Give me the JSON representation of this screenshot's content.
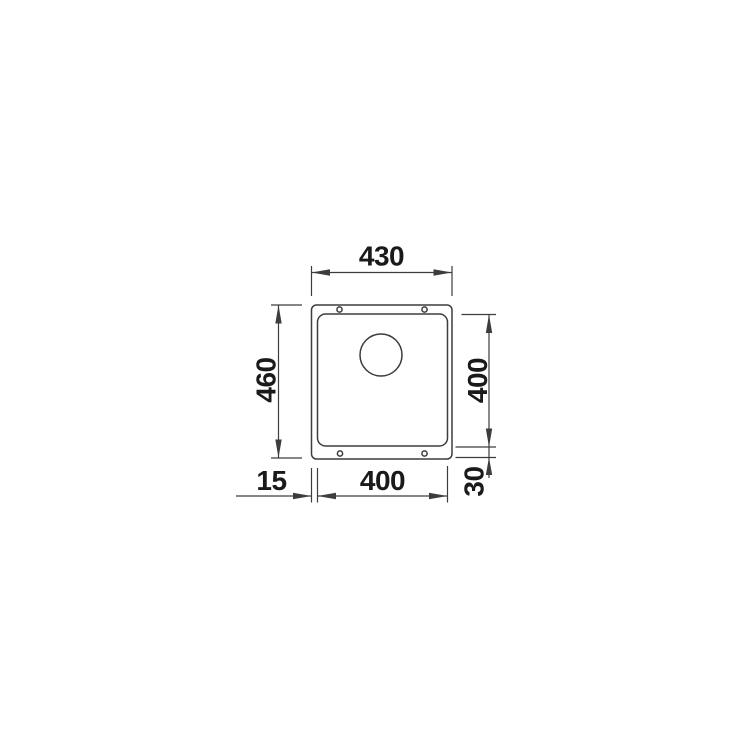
{
  "diagram": {
    "colors": {
      "background": "#ffffff",
      "line": "#3d3d3d",
      "text": "#1a1a1a"
    },
    "dimensions": {
      "outer_width": {
        "label": "430"
      },
      "outer_height": {
        "label": "460"
      },
      "basin_height": {
        "label": "400"
      },
      "basin_width": {
        "label": "400"
      },
      "left_rim_offset": {
        "label": "15"
      },
      "bottom_rim_offset": {
        "label": "30"
      }
    },
    "features": {
      "mounting_hole_count": 4,
      "drain_hole_count": 1
    }
  }
}
